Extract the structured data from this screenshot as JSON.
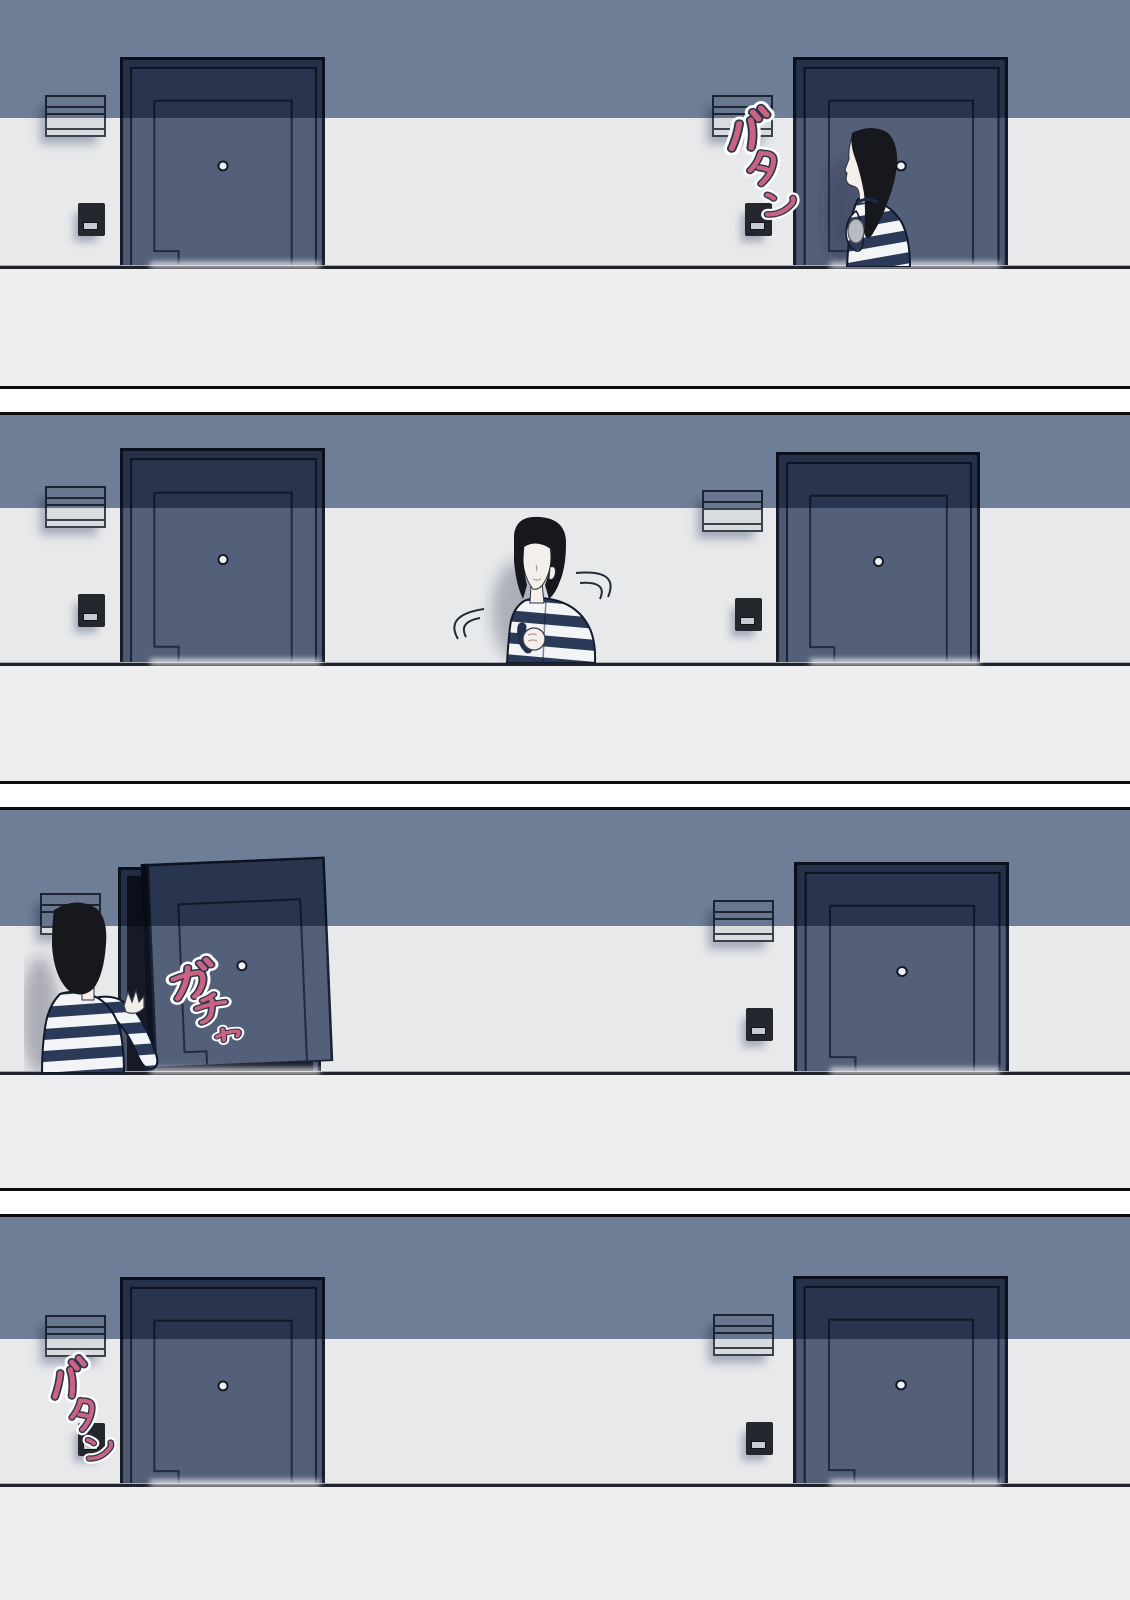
{
  "page": {
    "type": "four-panel-comic",
    "panel_count": 4
  },
  "panels": [
    {
      "label": "panel-1",
      "scene": "woman-at-right-apartment-door",
      "sfx": "バタン"
    },
    {
      "label": "panel-2",
      "scene": "woman-in-corridor-looking-around",
      "sfx": ""
    },
    {
      "label": "panel-3",
      "scene": "woman-opening-left-apartment-door",
      "sfx": "ガチャ"
    },
    {
      "label": "panel-4",
      "scene": "empty-corridor-doors-closed",
      "sfx": "バタン"
    }
  ],
  "colors": {
    "wall": "#E8E9EB",
    "parapet": "#EDEEF0",
    "shadow_band": "#68788F",
    "door_lit": "#545F79",
    "door_shadowed": "#2C3850",
    "door_outline": "#161D2B",
    "mailbox": "#D9DCDF",
    "intercom": "#24272D",
    "sfx_fill": "#C9637F",
    "sfx_outline": "#2B3550",
    "sfx_glow": "#FFFFFF",
    "hair": "#17181D",
    "skin": "#F4EFEA",
    "stripe_navy": "#2B3A59",
    "stripe_white": "#F3F4F6",
    "gap": "#FFFFFF"
  }
}
